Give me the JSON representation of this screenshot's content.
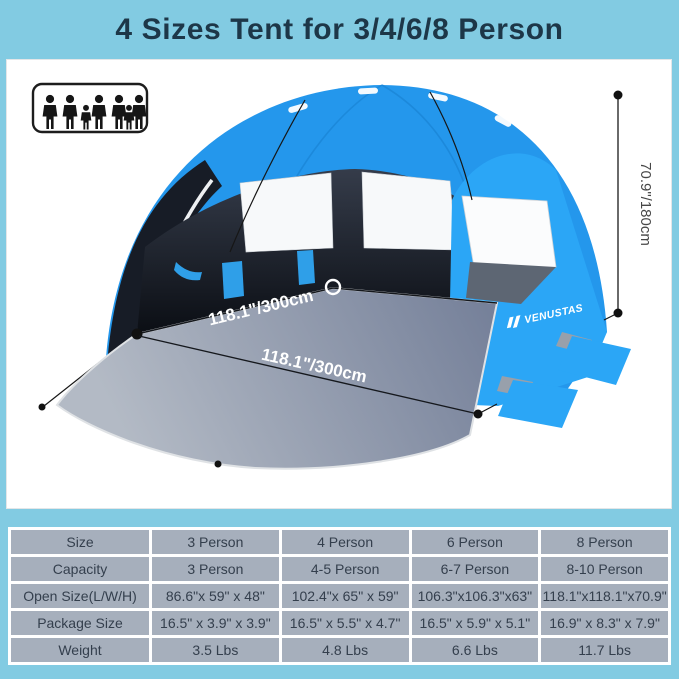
{
  "title": "4 Sizes Tent for 3/4/6/8 Person",
  "brand_logo": "VENUSTAS",
  "dimensions": {
    "floor_width": "118.1\"/300cm",
    "floor_depth": "118.1\"/300cm",
    "tent_height": "70.9\"/180cm"
  },
  "icons": {
    "capacity": "family-figures-icon"
  },
  "colors": {
    "frame_blue": "#82cbe2",
    "title_navy": "#1d3748",
    "tent_blue": "#2aa3f4",
    "interior_dark": "#11151d",
    "mat_gray": "#9aa4b4",
    "table_cell_gray": "#a6afbc"
  },
  "table": {
    "rows": [
      [
        "Size",
        "3 Person",
        "4 Person",
        "6 Person",
        "8 Person"
      ],
      [
        "Capacity",
        "3 Person",
        "4-5 Person",
        "6-7 Person",
        "8-10 Person"
      ],
      [
        "Open Size(L/W/H)",
        "86.6\"x 59\" x 48\"",
        "102.4\"x 65\" x 59\"",
        "106.3\"x106.3\"x63\"",
        "118.1\"x118.1\"x70.9\""
      ],
      [
        "Package Size",
        "16.5\" x 3.9\" x 3.9\"",
        "16.5\" x 5.5\" x 4.7\"",
        "16.5\" x 5.9\" x 5.1\"",
        "16.9\" x 8.3\" x 7.9\""
      ],
      [
        "Weight",
        "3.5 Lbs",
        "4.8 Lbs",
        "6.6 Lbs",
        "11.7 Lbs"
      ]
    ]
  }
}
